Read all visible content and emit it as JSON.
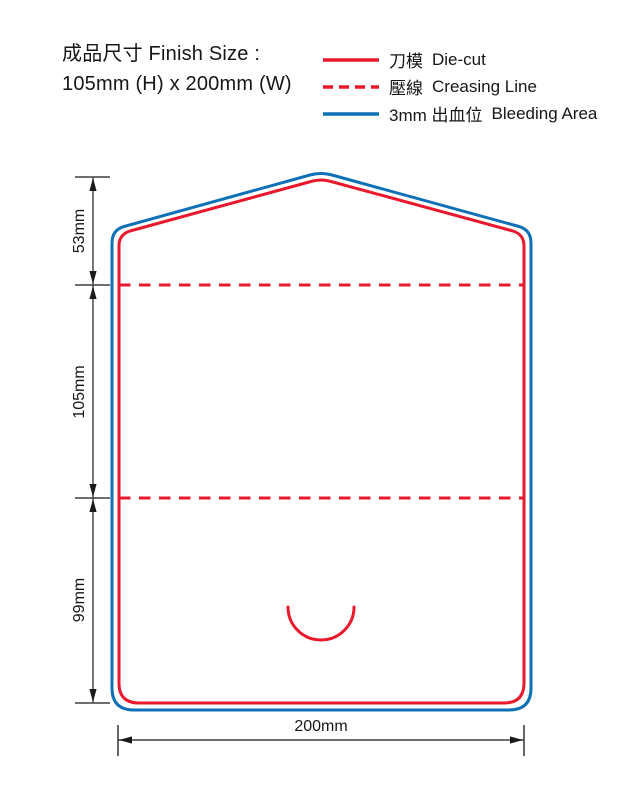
{
  "header": {
    "title_line1": "成品尺寸 Finish Size :",
    "title_line2": "105mm (H) x 200mm (W)"
  },
  "legend": {
    "items": [
      {
        "key": "die-cut",
        "zh": "刀模",
        "en": "Die-cut"
      },
      {
        "key": "creasing",
        "zh": "壓線",
        "en": "Creasing Line"
      },
      {
        "key": "bleeding",
        "zh": "3mm 出血位",
        "en": "Bleeding Area"
      }
    ]
  },
  "dimensions": {
    "top_section": "53mm",
    "middle_section": "105mm",
    "bottom_section": "99mm",
    "width": "200mm"
  },
  "colors": {
    "die_cut": "#e9182c",
    "bleed": "#0e71b8",
    "dimension": "#3f3f3f",
    "arrow": "#1a1a1a"
  }
}
